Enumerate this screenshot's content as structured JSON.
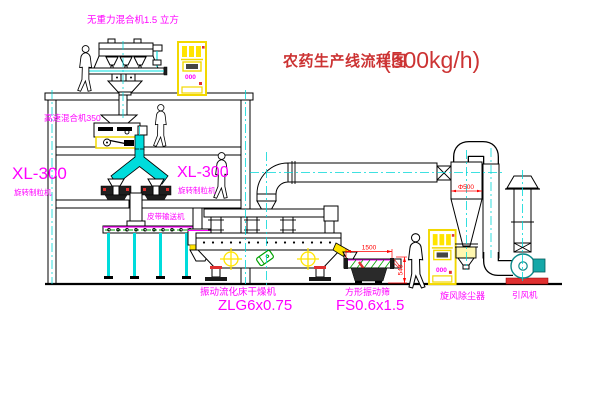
{
  "title": {
    "text": "农药生产线流程图",
    "capacity": "(500kg/h)"
  },
  "equipment_labels": {
    "gravity_mixer": "无重力混合机1.5 立方",
    "high_speed_mixer": "高速混合机350",
    "granulator_left_model": "XL-300",
    "granulator_left_name": "旋转制粒机",
    "granulator_right_model": "XL-300",
    "granulator_right_name": "旋转制粒机",
    "belt_conveyor": "皮带输送机",
    "dryer_name": "振动流化床干燥机",
    "dryer_model": "ZLG6x0.75",
    "screen_name": "方形振动筛",
    "screen_model": "FS0.6x1.5",
    "cyclone_name": "旋风除尘器",
    "fan_name": "引风机"
  },
  "dimensions": {
    "screen_length": "1500",
    "screen_height": "540",
    "cyclone_diameter": "Φ500"
  },
  "control_panels": {
    "top_panel_display": "000",
    "right_panel_display": "000"
  },
  "colors": {
    "line": "#000000",
    "centerline_cyan": "#00d8d8",
    "pipe_cyan": "#00dcdc",
    "label_magenta": "#ff00ff",
    "title_red": "#cc3333",
    "dimension_red": "#ff0000",
    "highlight_yellow": "#ffe400",
    "belt_green": "#00a000",
    "fan_teal": "#15a8a8"
  }
}
